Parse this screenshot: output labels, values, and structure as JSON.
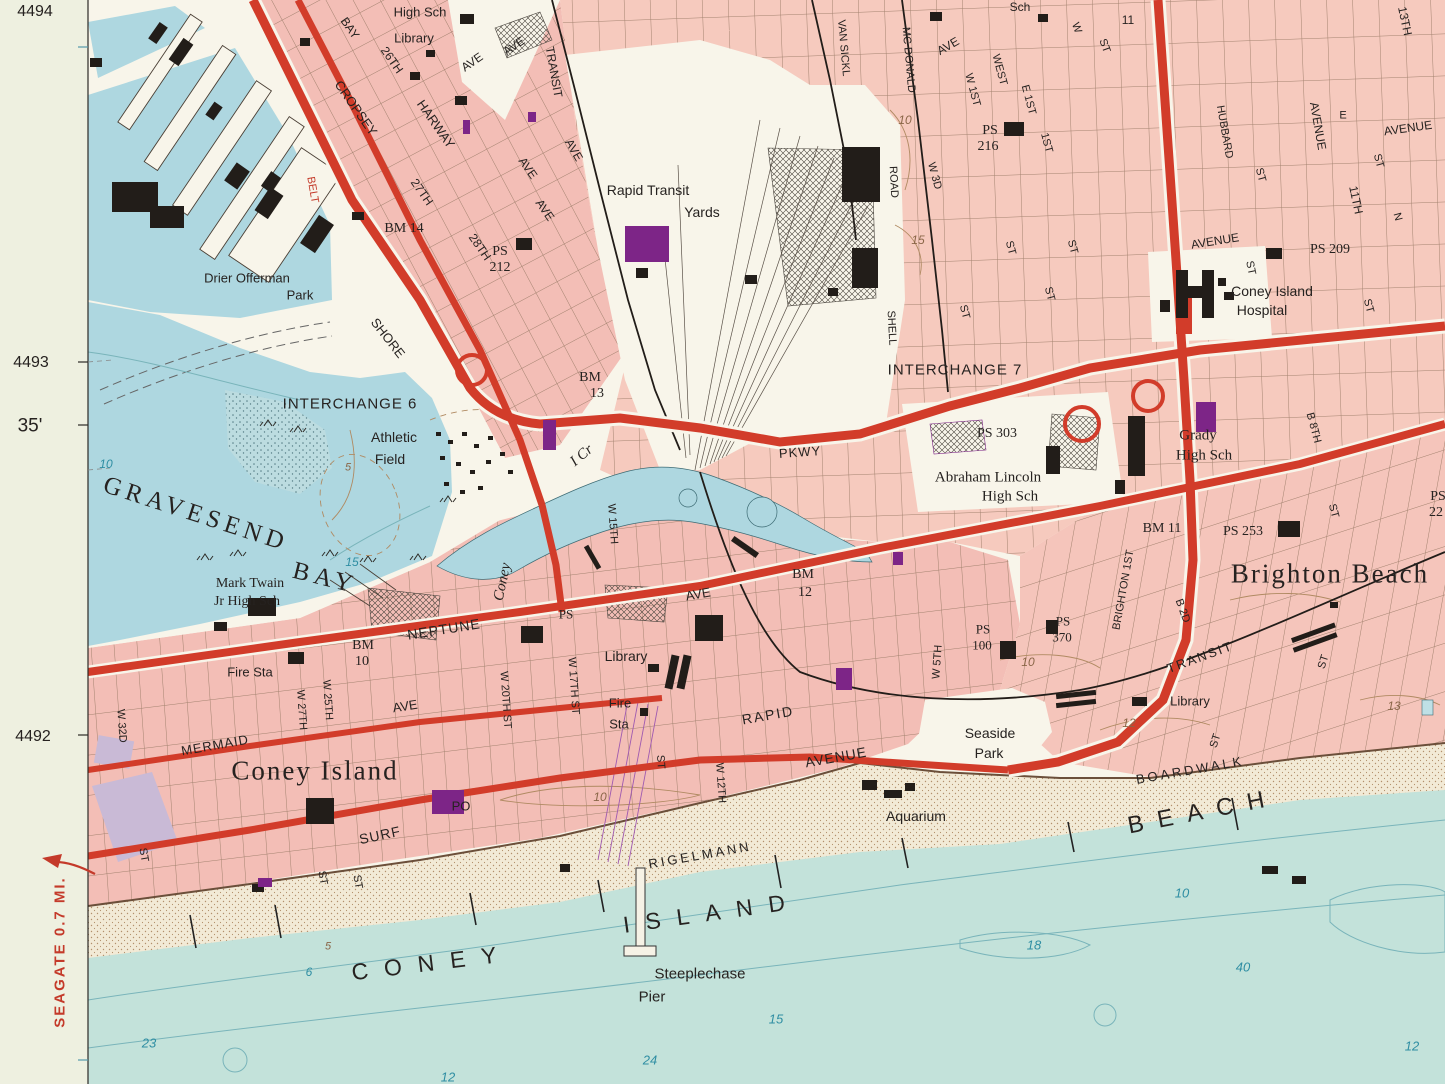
{
  "map": {
    "sheet_name": "Coney Island topographic quadrangle (detail)",
    "colors": {
      "margin": "#eef0e0",
      "urban_pink": "#f3beb6",
      "urban_pink_light": "#f6cabe",
      "water_bay": "#aed7e0",
      "water_ocean": "#c3e2da",
      "sand": "#f2ead6",
      "road_red": "#d23c2a",
      "building_black": "#221d19",
      "building_purple": "#7d2587",
      "contour_brown": "#b08a62",
      "contour_teal": "#79b4ba",
      "ink": "#262220"
    },
    "margin": {
      "grid_refs": [
        "4494",
        "4493",
        "4492"
      ],
      "minute_label": "35'",
      "edge_note": "SEAGATE 0.7 MI."
    },
    "labels": [
      {
        "t": "4494",
        "x": 35,
        "y": 12,
        "s": 16
      },
      {
        "t": "4493",
        "x": 31,
        "y": 363,
        "s": 16
      },
      {
        "t": "35'",
        "x": 30,
        "y": 426,
        "s": 19
      },
      {
        "t": "4492",
        "x": 33,
        "y": 737,
        "s": 16
      },
      {
        "t": "SEAGATE 0.7 MI.",
        "x": 60,
        "y": 952,
        "r": -90,
        "s": 15,
        "c": "red",
        "ls": 2,
        "w": 1
      },
      {
        "t": "High Sch",
        "x": 420,
        "y": 12,
        "s": 13
      },
      {
        "t": "Library",
        "x": 414,
        "y": 38,
        "s": 13
      },
      {
        "t": "Sch",
        "x": 1020,
        "y": 7,
        "s": 12
      },
      {
        "t": "BAY",
        "x": 350,
        "y": 28,
        "r": 55,
        "s": 12
      },
      {
        "t": "26TH",
        "x": 392,
        "y": 60,
        "r": 55,
        "s": 12
      },
      {
        "t": "CROPSEY",
        "x": 356,
        "y": 108,
        "r": 55,
        "s": 13
      },
      {
        "t": "HARWAY",
        "x": 436,
        "y": 124,
        "r": 55,
        "s": 13
      },
      {
        "t": "27TH",
        "x": 422,
        "y": 192,
        "r": 55,
        "s": 12
      },
      {
        "t": "28TH",
        "x": 480,
        "y": 247,
        "r": 55,
        "s": 12
      },
      {
        "t": "AVE",
        "x": 472,
        "y": 62,
        "r": -35,
        "s": 12
      },
      {
        "t": "AVE",
        "x": 514,
        "y": 46,
        "r": -35,
        "s": 12
      },
      {
        "t": "TRANSIT",
        "x": 554,
        "y": 72,
        "r": 80,
        "s": 12
      },
      {
        "t": "AVE",
        "x": 574,
        "y": 150,
        "r": 60,
        "s": 12
      },
      {
        "t": "AVE",
        "x": 528,
        "y": 168,
        "r": 55,
        "s": 12
      },
      {
        "t": "AVE",
        "x": 545,
        "y": 210,
        "r": 55,
        "s": 12
      },
      {
        "t": "BELT",
        "x": 312,
        "y": 190,
        "r": 80,
        "s": 11,
        "c": "red"
      },
      {
        "t": "SHORE",
        "x": 388,
        "y": 338,
        "r": 52,
        "s": 13
      },
      {
        "t": "BM 14",
        "x": 404,
        "y": 229,
        "s": 14,
        "f": "serif"
      },
      {
        "t": "PS",
        "x": 500,
        "y": 252,
        "s": 14,
        "f": "serif"
      },
      {
        "t": "212",
        "x": 500,
        "y": 268,
        "s": 14,
        "f": "serif"
      },
      {
        "t": "Drier Offerman",
        "x": 247,
        "y": 278,
        "s": 13
      },
      {
        "t": "Park",
        "x": 300,
        "y": 295,
        "s": 13
      },
      {
        "t": "Rapid Transit",
        "x": 648,
        "y": 190,
        "s": 14
      },
      {
        "t": "Yards",
        "x": 702,
        "y": 212,
        "s": 14
      },
      {
        "t": "VAN SICKL",
        "x": 843,
        "y": 48,
        "r": 85,
        "s": 11
      },
      {
        "t": "MC DONALD",
        "x": 908,
        "y": 60,
        "r": 85,
        "s": 11
      },
      {
        "t": "AVE",
        "x": 948,
        "y": 46,
        "r": -30,
        "s": 12
      },
      {
        "t": "WEST",
        "x": 999,
        "y": 70,
        "r": 75,
        "s": 11
      },
      {
        "t": "W 1ST",
        "x": 972,
        "y": 90,
        "r": 75,
        "s": 11
      },
      {
        "t": "E 1ST",
        "x": 1028,
        "y": 100,
        "r": 75,
        "s": 11
      },
      {
        "t": "10",
        "x": 905,
        "y": 120,
        "s": 12,
        "c": "brown",
        "i": 1
      },
      {
        "t": "PS",
        "x": 990,
        "y": 131,
        "s": 14,
        "f": "serif"
      },
      {
        "t": "216",
        "x": 988,
        "y": 147,
        "s": 14,
        "f": "serif"
      },
      {
        "t": "W 3D",
        "x": 934,
        "y": 176,
        "r": 75,
        "s": 11
      },
      {
        "t": "ROAD",
        "x": 893,
        "y": 182,
        "r": 87,
        "s": 11
      },
      {
        "t": "SHELL",
        "x": 891,
        "y": 328,
        "r": 87,
        "s": 11
      },
      {
        "t": "15",
        "x": 918,
        "y": 240,
        "s": 12,
        "c": "brown",
        "i": 1
      },
      {
        "t": "W",
        "x": 1076,
        "y": 28,
        "r": 70,
        "s": 11
      },
      {
        "t": "11",
        "x": 1128,
        "y": 20,
        "s": 12
      },
      {
        "t": "ST",
        "x": 1104,
        "y": 46,
        "r": 70,
        "s": 11
      },
      {
        "t": "1ST",
        "x": 1046,
        "y": 143,
        "r": 75,
        "s": 11
      },
      {
        "t": "ST",
        "x": 1010,
        "y": 248,
        "r": 75,
        "s": 11
      },
      {
        "t": "ST",
        "x": 1072,
        "y": 247,
        "r": 75,
        "s": 11
      },
      {
        "t": "ST",
        "x": 964,
        "y": 312,
        "r": 75,
        "s": 11
      },
      {
        "t": "ST",
        "x": 1049,
        "y": 294,
        "r": 75,
        "s": 11
      },
      {
        "t": "HUBBARD",
        "x": 1224,
        "y": 132,
        "r": 80,
        "s": 11
      },
      {
        "t": "ST",
        "x": 1260,
        "y": 175,
        "r": 75,
        "s": 11
      },
      {
        "t": "AVENUE",
        "x": 1318,
        "y": 126,
        "r": 80,
        "s": 12
      },
      {
        "t": "E",
        "x": 1343,
        "y": 116,
        "s": 11
      },
      {
        "t": "AVENUE",
        "x": 1408,
        "y": 128,
        "r": -8,
        "s": 12
      },
      {
        "t": "ST",
        "x": 1378,
        "y": 161,
        "r": 75,
        "s": 11
      },
      {
        "t": "13TH",
        "x": 1405,
        "y": 21,
        "r": 78,
        "s": 12
      },
      {
        "t": "11TH",
        "x": 1356,
        "y": 200,
        "r": 78,
        "s": 12
      },
      {
        "t": "N",
        "x": 1397,
        "y": 217,
        "r": 75,
        "s": 11
      },
      {
        "t": "AVENUE",
        "x": 1215,
        "y": 241,
        "r": -9,
        "s": 12
      },
      {
        "t": "PS 209",
        "x": 1330,
        "y": 250,
        "s": 14,
        "f": "serif"
      },
      {
        "t": "ST",
        "x": 1250,
        "y": 268,
        "r": 78,
        "s": 11
      },
      {
        "t": "Coney Island",
        "x": 1272,
        "y": 291,
        "s": 14
      },
      {
        "t": "Hospital",
        "x": 1262,
        "y": 310,
        "s": 14
      },
      {
        "t": "ST",
        "x": 1368,
        "y": 306,
        "r": 75,
        "s": 11
      },
      {
        "t": "INTERCHANGE 7",
        "x": 955,
        "y": 370,
        "s": 15,
        "ls": 1
      },
      {
        "t": "INTERCHANGE 6",
        "x": 350,
        "y": 404,
        "s": 15,
        "ls": 1
      },
      {
        "t": "BM",
        "x": 590,
        "y": 378,
        "s": 14,
        "f": "serif"
      },
      {
        "t": "13",
        "x": 597,
        "y": 394,
        "s": 14,
        "f": "serif"
      },
      {
        "t": "PKWY",
        "x": 800,
        "y": 452,
        "r": -4,
        "s": 13,
        "ls": 1
      },
      {
        "t": "Athletic",
        "x": 394,
        "y": 437,
        "s": 14
      },
      {
        "t": "Field",
        "x": 390,
        "y": 459,
        "s": 14
      },
      {
        "t": "PS 303",
        "x": 997,
        "y": 434,
        "s": 14,
        "f": "serif"
      },
      {
        "t": "Abraham Lincoln",
        "x": 988,
        "y": 478,
        "s": 15,
        "f": "serif"
      },
      {
        "t": "High Sch",
        "x": 1010,
        "y": 497,
        "s": 15,
        "f": "serif"
      },
      {
        "t": "Grady",
        "x": 1198,
        "y": 436,
        "s": 15,
        "f": "serif"
      },
      {
        "t": "High Sch",
        "x": 1204,
        "y": 456,
        "s": 15,
        "f": "serif"
      },
      {
        "t": "5",
        "x": 348,
        "y": 468,
        "s": 11,
        "c": "brown",
        "i": 1
      },
      {
        "t": "GRAVESEND",
        "x": 196,
        "y": 514,
        "r": 18,
        "s": 25,
        "f": "serif",
        "ls": 5
      },
      {
        "t": "BAY",
        "x": 325,
        "y": 578,
        "r": 14,
        "s": 25,
        "f": "serif",
        "ls": 5
      },
      {
        "t": "Coney",
        "x": 503,
        "y": 582,
        "r": -78,
        "s": 15,
        "f": "serif",
        "i": 1
      },
      {
        "t": "I Cr",
        "x": 582,
        "y": 456,
        "r": -40,
        "s": 15,
        "f": "serif",
        "i": 1
      },
      {
        "t": "W 15TH",
        "x": 612,
        "y": 524,
        "r": 86,
        "s": 11
      },
      {
        "t": "10",
        "x": 106,
        "y": 464,
        "s": 12,
        "c": "teal",
        "i": 1
      },
      {
        "t": "15",
        "x": 352,
        "y": 562,
        "s": 12,
        "c": "teal",
        "i": 1
      },
      {
        "t": "Mark Twain",
        "x": 250,
        "y": 584,
        "s": 14,
        "f": "serif"
      },
      {
        "t": "Jr High Sch",
        "x": 247,
        "y": 602,
        "s": 14,
        "f": "serif"
      },
      {
        "t": "BM 11",
        "x": 1162,
        "y": 529,
        "s": 14,
        "f": "serif"
      },
      {
        "t": "PS 253",
        "x": 1243,
        "y": 532,
        "s": 14,
        "f": "serif"
      },
      {
        "t": "PS",
        "x": 1438,
        "y": 497,
        "s": 14,
        "f": "serif"
      },
      {
        "t": "22",
        "x": 1436,
        "y": 513,
        "s": 14,
        "f": "serif"
      },
      {
        "t": "Brighton Beach",
        "x": 1330,
        "y": 574,
        "s": 27,
        "f": "serif",
        "ls": 2
      },
      {
        "t": "B 8TH",
        "x": 1313,
        "y": 428,
        "r": 75,
        "s": 11
      },
      {
        "t": "ST",
        "x": 1333,
        "y": 511,
        "r": 75,
        "s": 11
      },
      {
        "t": "ST",
        "x": 1324,
        "y": 662,
        "r": -72,
        "s": 11
      },
      {
        "t": "B 2D",
        "x": 1182,
        "y": 611,
        "r": 70,
        "s": 11
      },
      {
        "t": "BRIGHTON 1ST",
        "x": 1124,
        "y": 590,
        "r": -80,
        "s": 11
      },
      {
        "t": "TRANSIT",
        "x": 1200,
        "y": 657,
        "r": -20,
        "s": 13,
        "ls": 2
      },
      {
        "t": "Library",
        "x": 1190,
        "y": 701,
        "s": 13
      },
      {
        "t": "12",
        "x": 1129,
        "y": 723,
        "s": 12,
        "c": "brown",
        "i": 1
      },
      {
        "t": "13",
        "x": 1394,
        "y": 706,
        "s": 12,
        "c": "brown",
        "i": 1
      },
      {
        "t": "ST",
        "x": 1216,
        "y": 741,
        "r": -72,
        "s": 11
      },
      {
        "t": "NEPTUNE",
        "x": 444,
        "y": 629,
        "r": -9,
        "s": 14,
        "ls": 1
      },
      {
        "t": "BM",
        "x": 363,
        "y": 646,
        "s": 14,
        "f": "serif"
      },
      {
        "t": "10",
        "x": 362,
        "y": 662,
        "s": 14,
        "f": "serif"
      },
      {
        "t": "Fire Sta",
        "x": 250,
        "y": 672,
        "s": 13
      },
      {
        "t": "W 25TH",
        "x": 327,
        "y": 700,
        "r": 86,
        "s": 11
      },
      {
        "t": "W 27TH",
        "x": 301,
        "y": 710,
        "r": 86,
        "s": 11
      },
      {
        "t": "W 20TH ST",
        "x": 505,
        "y": 700,
        "r": 86,
        "s": 11
      },
      {
        "t": "W 17TH ST",
        "x": 573,
        "y": 686,
        "r": 86,
        "s": 11
      },
      {
        "t": "PS",
        "x": 566,
        "y": 614,
        "s": 13,
        "f": "serif"
      },
      {
        "t": "Library",
        "x": 626,
        "y": 656,
        "s": 14
      },
      {
        "t": "Fire",
        "x": 620,
        "y": 703,
        "s": 13
      },
      {
        "t": "Sta",
        "x": 619,
        "y": 724,
        "s": 13
      },
      {
        "t": "AVE",
        "x": 698,
        "y": 594,
        "r": -10,
        "s": 13
      },
      {
        "t": "BM",
        "x": 803,
        "y": 575,
        "s": 14,
        "f": "serif"
      },
      {
        "t": "12",
        "x": 805,
        "y": 593,
        "s": 14,
        "f": "serif"
      },
      {
        "t": "ST",
        "x": 660,
        "y": 762,
        "r": 86,
        "s": 11
      },
      {
        "t": "W 12TH",
        "x": 720,
        "y": 783,
        "r": 86,
        "s": 11
      },
      {
        "t": "RAPID",
        "x": 768,
        "y": 715,
        "r": -10,
        "s": 14,
        "ls": 2
      },
      {
        "t": "AVENUE",
        "x": 836,
        "y": 757,
        "r": -10,
        "s": 14,
        "ls": 1
      },
      {
        "t": "MERMAID",
        "x": 215,
        "y": 745,
        "r": -10,
        "s": 13,
        "ls": 1
      },
      {
        "t": "AVE",
        "x": 405,
        "y": 706,
        "r": -9,
        "s": 13
      },
      {
        "t": "W 32D",
        "x": 121,
        "y": 726,
        "r": 86,
        "s": 11
      },
      {
        "t": "Coney Island",
        "x": 315,
        "y": 771,
        "s": 27,
        "f": "serif",
        "ls": 2
      },
      {
        "t": "SURF",
        "x": 380,
        "y": 835,
        "r": -12,
        "s": 14,
        "ls": 1
      },
      {
        "t": "PO",
        "x": 461,
        "y": 806,
        "s": 13
      },
      {
        "t": "ST",
        "x": 143,
        "y": 855,
        "r": 80,
        "s": 11
      },
      {
        "t": "ST",
        "x": 322,
        "y": 878,
        "r": 80,
        "s": 11
      },
      {
        "t": "ST",
        "x": 357,
        "y": 882,
        "r": 80,
        "s": 11
      },
      {
        "t": "W 5TH",
        "x": 938,
        "y": 662,
        "r": -86,
        "s": 11
      },
      {
        "t": "PS",
        "x": 983,
        "y": 629,
        "s": 13,
        "f": "serif"
      },
      {
        "t": "100",
        "x": 982,
        "y": 645,
        "s": 13,
        "f": "serif"
      },
      {
        "t": "PS",
        "x": 1063,
        "y": 621,
        "s": 13,
        "f": "serif"
      },
      {
        "t": "370",
        "x": 1062,
        "y": 637,
        "s": 13,
        "f": "serif"
      },
      {
        "t": "10",
        "x": 1028,
        "y": 662,
        "s": 12,
        "c": "brown",
        "i": 1
      },
      {
        "t": "Seaside",
        "x": 990,
        "y": 733,
        "s": 14
      },
      {
        "t": "Park",
        "x": 989,
        "y": 753,
        "s": 14
      },
      {
        "t": "10",
        "x": 600,
        "y": 797,
        "s": 12,
        "c": "brown",
        "i": 1
      },
      {
        "t": "BOARDWALK",
        "x": 1190,
        "y": 770,
        "r": -10,
        "s": 13,
        "ls": 3
      },
      {
        "t": "Aquarium",
        "x": 916,
        "y": 816,
        "s": 14
      },
      {
        "t": "RIGELMANN",
        "x": 700,
        "y": 855,
        "r": -10,
        "s": 13,
        "ls": 3
      },
      {
        "t": "BEACH",
        "x": 1203,
        "y": 812,
        "r": -11,
        "s": 24,
        "ls": 14
      },
      {
        "t": "CONEY",
        "x": 432,
        "y": 963,
        "r": -7,
        "s": 23,
        "ls": 16
      },
      {
        "t": "ISLAND",
        "x": 712,
        "y": 913,
        "r": -8,
        "s": 23,
        "ls": 16
      },
      {
        "t": "Steeplechase",
        "x": 700,
        "y": 974,
        "s": 15
      },
      {
        "t": "Pier",
        "x": 652,
        "y": 997,
        "s": 15
      },
      {
        "t": "5",
        "x": 328,
        "y": 947,
        "s": 11,
        "c": "brown",
        "i": 1
      },
      {
        "t": "6",
        "x": 309,
        "y": 972,
        "s": 12,
        "c": "teal",
        "i": 1
      },
      {
        "t": "23",
        "x": 149,
        "y": 1043,
        "s": 13,
        "c": "teal",
        "i": 1
      },
      {
        "t": "15",
        "x": 776,
        "y": 1019,
        "s": 13,
        "c": "teal",
        "i": 1
      },
      {
        "t": "24",
        "x": 650,
        "y": 1060,
        "s": 13,
        "c": "teal",
        "i": 1
      },
      {
        "t": "12",
        "x": 448,
        "y": 1077,
        "s": 13,
        "c": "teal",
        "i": 1
      },
      {
        "t": "10",
        "x": 1182,
        "y": 893,
        "s": 13,
        "c": "teal",
        "i": 1
      },
      {
        "t": "18",
        "x": 1034,
        "y": 945,
        "s": 13,
        "c": "teal",
        "i": 1
      },
      {
        "t": "40",
        "x": 1243,
        "y": 967,
        "s": 13,
        "c": "teal",
        "i": 1
      },
      {
        "t": "12",
        "x": 1412,
        "y": 1046,
        "s": 13,
        "c": "teal",
        "i": 1
      }
    ]
  }
}
